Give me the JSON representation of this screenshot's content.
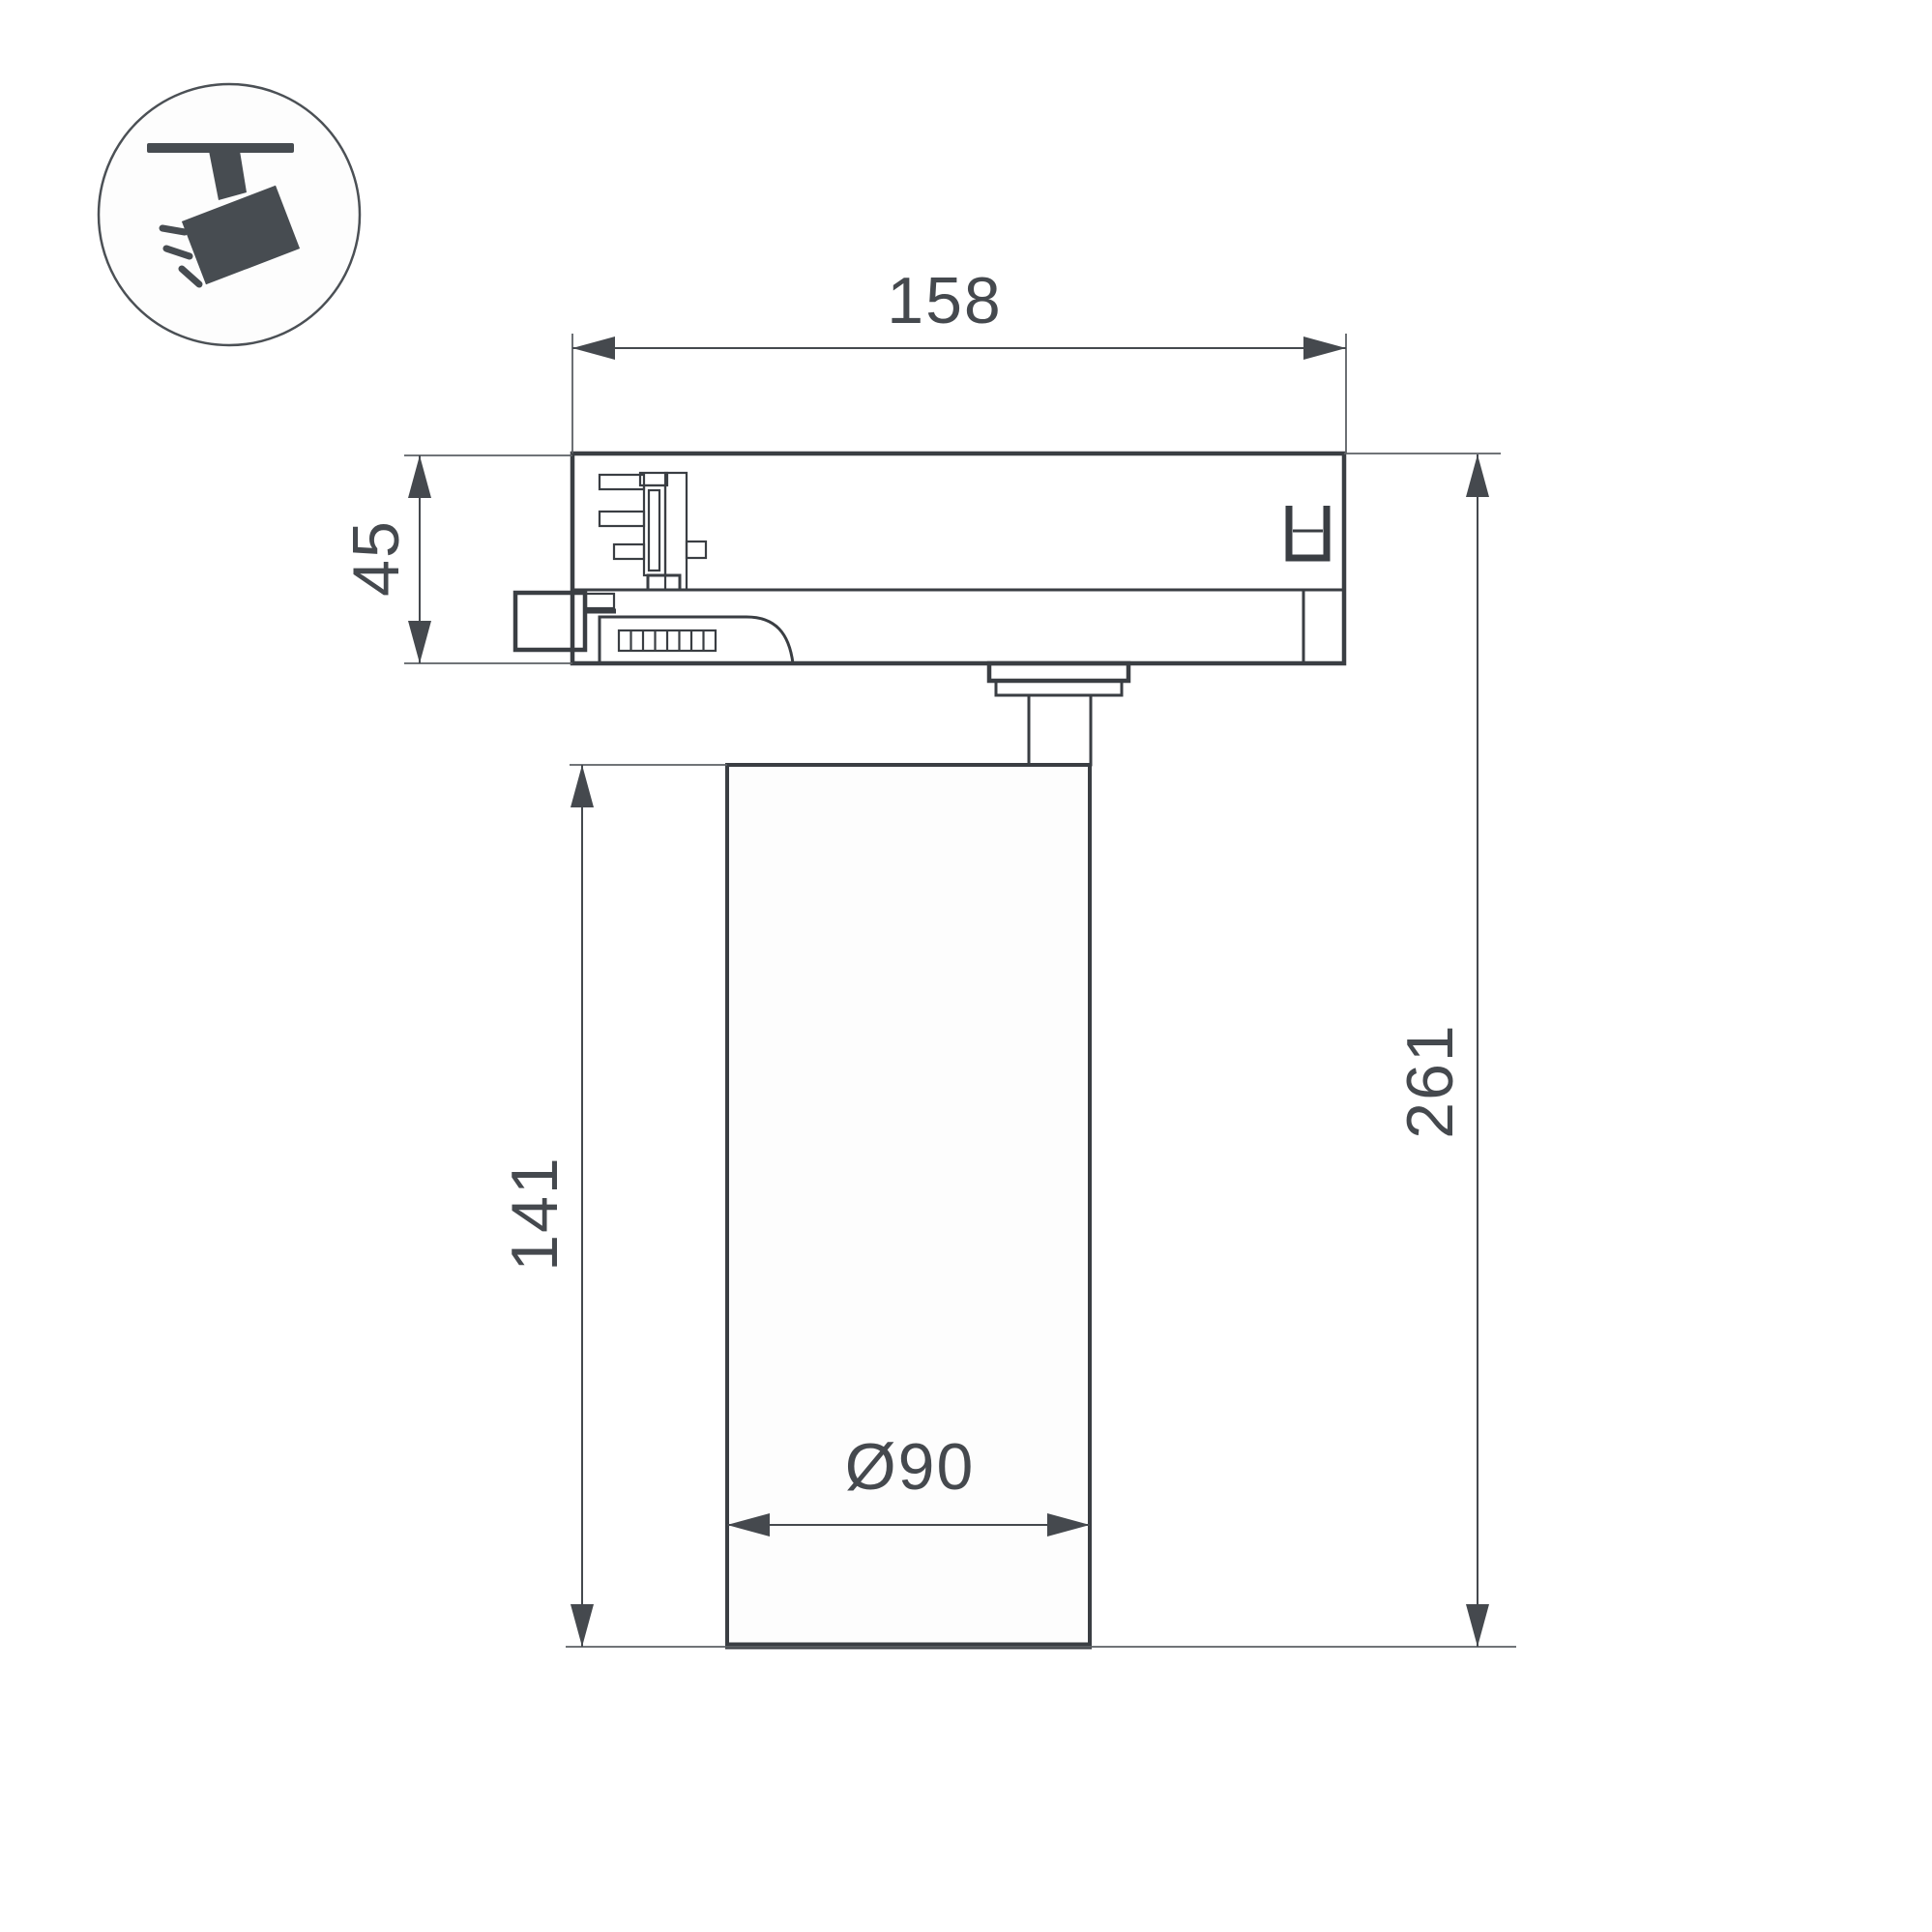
{
  "title": "track-spotlight-dimension-drawing",
  "colors": {
    "background": "#ffffff",
    "line": "#3a3e43",
    "dim_line": "#45494e",
    "ext_line": "#5c6064",
    "icon": "#474c51"
  },
  "icon": {
    "label": "track-mounted-spotlight-pictogram"
  },
  "dimensions": {
    "adapter_width": "158",
    "adapter_height": "45",
    "body_height": "141",
    "total_height": "261",
    "body_diameter": "Ø90"
  }
}
